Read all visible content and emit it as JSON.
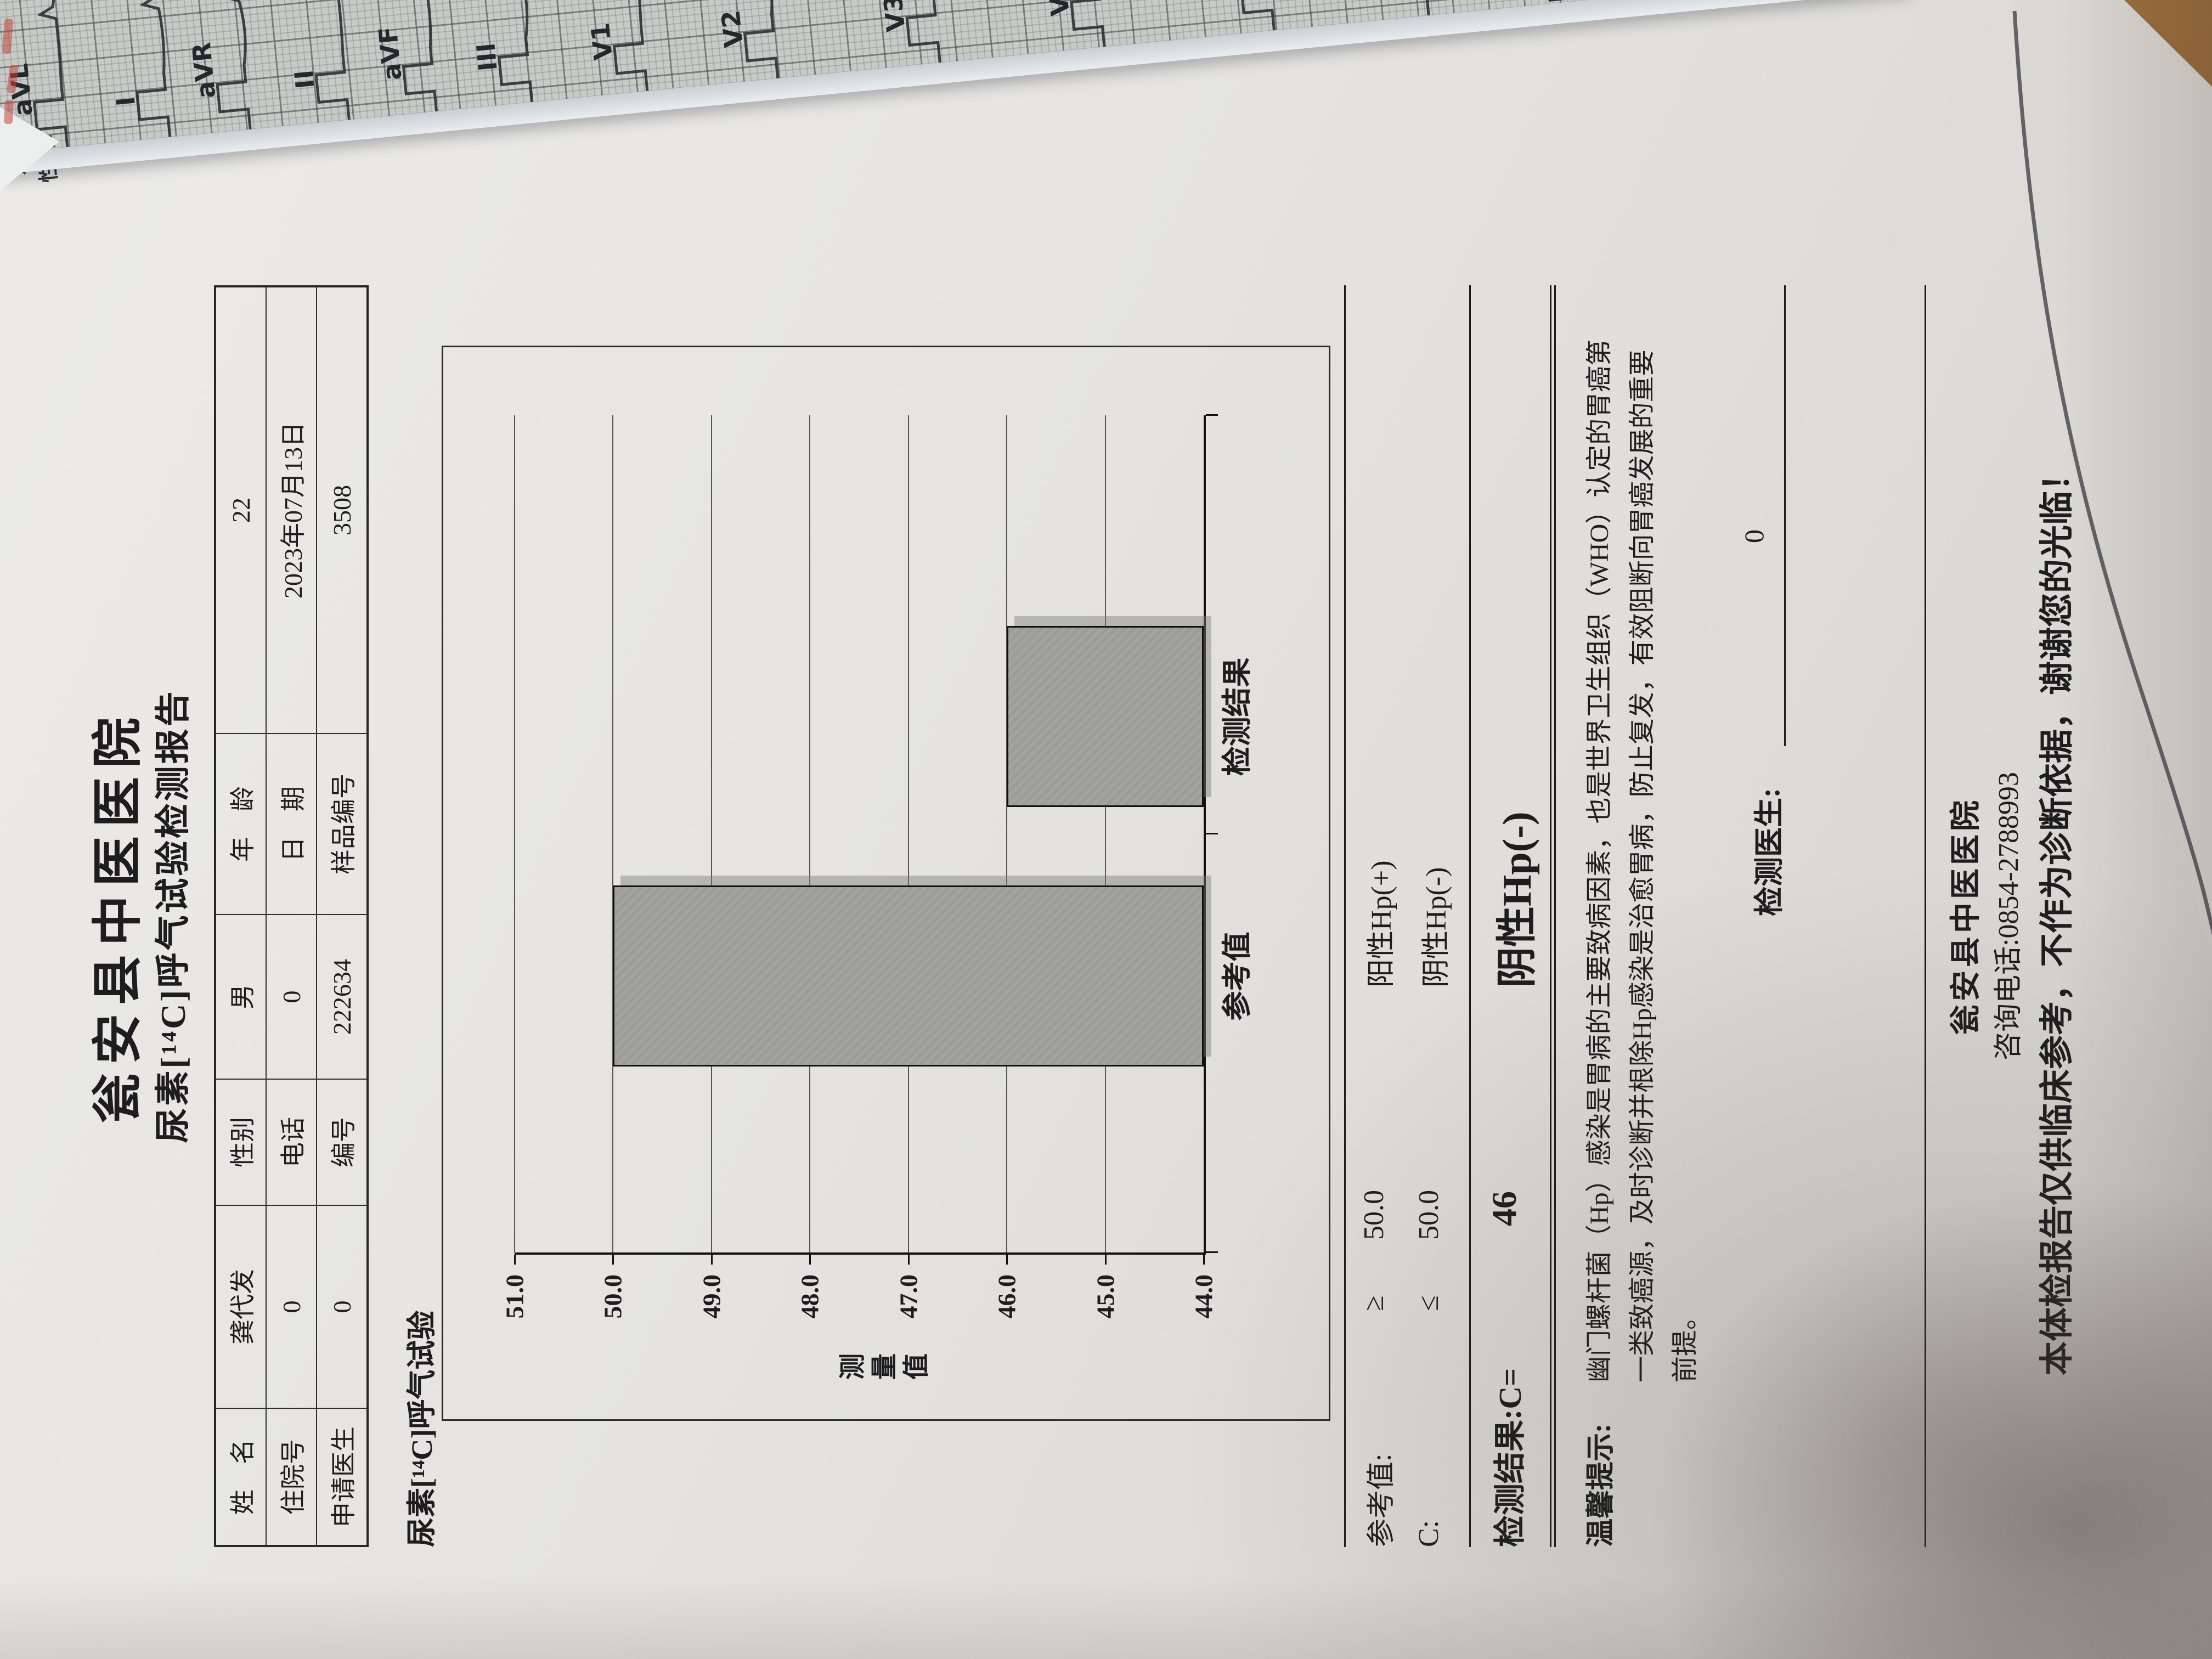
{
  "colors": {
    "paper": "#e4e3e0",
    "ecg_grid_paper": "#c8cac8",
    "table_wood": "#b9854e",
    "bar_fill": "#a3a3a0",
    "ink": "#1d1d1f"
  },
  "chart_data": {
    "type": "bar",
    "categories": [
      "参考值",
      "检测结果"
    ],
    "values": [
      50.0,
      46.0
    ],
    "title": "尿素[¹⁴C]呼气试验",
    "xlabel": "",
    "ylabel": "测量值",
    "ylim": [
      44.0,
      51.0
    ],
    "yticks": [
      51.0,
      50.0,
      49.0,
      48.0,
      47.0,
      46.0,
      45.0,
      44.0
    ],
    "bar_centers_pct": [
      33,
      64
    ],
    "grid": true,
    "legend": "none"
  },
  "report": {
    "hospital_title": "瓮安县中医医院",
    "report_title": "尿素[¹⁴C]呼气试验检测报告",
    "patient_table": {
      "rows": [
        [
          "姓　名",
          "龚代发",
          "性别",
          "男",
          "年　龄",
          "22"
        ],
        [
          "住院号",
          "0",
          "电话",
          "0",
          "日　期",
          "2023年07月13日"
        ],
        [
          "申请医生",
          "0",
          "编号",
          "222634",
          "样品编号",
          "3508"
        ]
      ]
    },
    "section_heading": "尿素[¹⁴C]呼气试验",
    "results": {
      "rows": [
        {
          "label": "参考值:",
          "op": "≥",
          "value": "50.0",
          "verdict": "阳性Hp(+)"
        },
        {
          "label": "C:",
          "op": "≤",
          "value": "50.0",
          "verdict": "阴性Hp(-)"
        }
      ],
      "result": {
        "label": "检测结果:C=",
        "value": "46",
        "verdict": "阴性Hp(-)"
      }
    },
    "tips": {
      "label": "温馨提示:",
      "lines": [
        "幽门螺杆菌（Hp）感染是胃病的主要致病因素，也是世界卫生组织（WHO）认定的胃癌第",
        "一类致癌源，及时诊断并根除Hp感染是治愈胃病，防止复发，有效阻断向胃癌发展的重要",
        "前提。"
      ]
    },
    "doctor": {
      "label": "检测医生:",
      "value": "0"
    },
    "footer": {
      "hospital": "瓮安县中医医院",
      "phone": "咨询电话:0854-2788993",
      "disclaimer": "本体检报告仅供临床参考，不作为诊断依据，谢谢您的光临！",
      "page": "第 7 页 共 8页"
    }
  },
  "ecg": {
    "leads": [
      "aVL",
      "I",
      "aVR",
      "II",
      "aVF",
      "III",
      "V1",
      "V2",
      "V3",
      "V4",
      "V5",
      "V6"
    ],
    "lead_x": [
      127,
      315,
      462,
      643,
      803,
      978,
      1189,
      1428,
      1725,
      2026,
      2337,
      2620
    ],
    "params": [
      "心率",
      "QRS",
      "PR",
      "P/Q",
      "QT",
      "RV5",
      "R+"
    ],
    "param_note": "准",
    "header_labels": [
      "姓名:",
      "性别:"
    ]
  }
}
